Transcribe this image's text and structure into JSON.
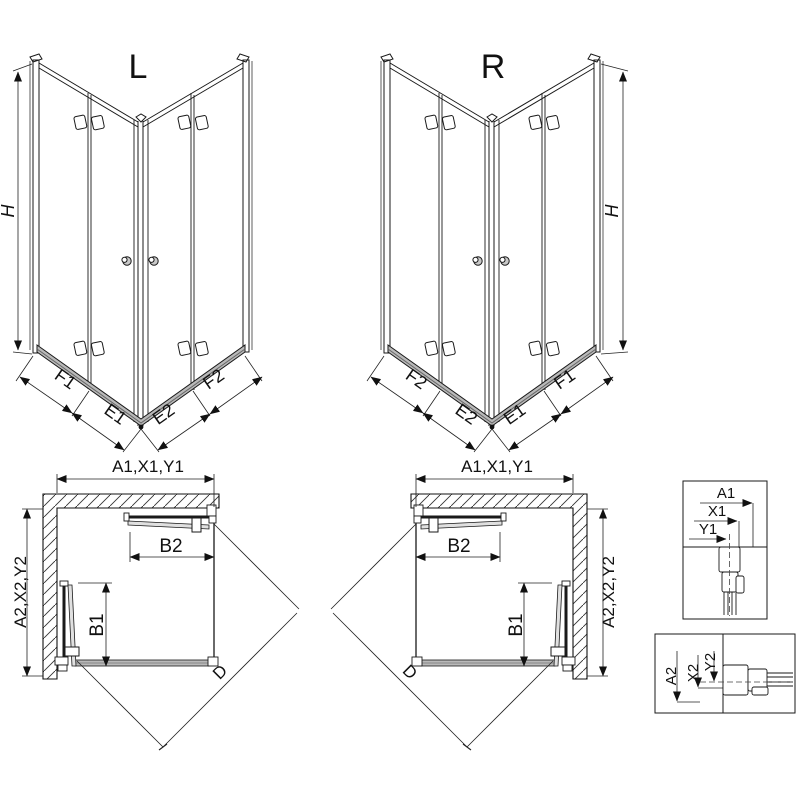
{
  "figures": {
    "iso_l": {
      "title": "L",
      "height_label": "H",
      "dims": {
        "left_outer": "F1",
        "left_inner": "E1",
        "right_inner": "E2",
        "right_outer": "F2"
      }
    },
    "iso_r": {
      "title": "R",
      "height_label": "H",
      "dims": {
        "left_outer": "F2",
        "left_inner": "E2",
        "right_inner": "E1",
        "right_outer": "F1"
      }
    },
    "plan_l": {
      "width_dim": "A1,X1,Y1",
      "depth_dim": "A2,X2,Y2",
      "door_top": "B2",
      "door_side": "B1",
      "diagonal": "D"
    },
    "plan_r": {
      "width_dim": "A1,X1,Y1",
      "depth_dim": "A2,X2,Y2",
      "door_top": "B2",
      "door_side": "B1",
      "diagonal": "D"
    },
    "detail_top": {
      "a": "A1",
      "x": "X1",
      "y": "Y1"
    },
    "detail_bottom": {
      "a": "A2",
      "x": "X2",
      "y": "Y2"
    }
  },
  "colors": {
    "line": "#1a1a1a",
    "dim_line": "#222222",
    "hatch": "#333333",
    "tray_gray": "#b9b9b9",
    "panel_gray": "#e0e0e0"
  }
}
